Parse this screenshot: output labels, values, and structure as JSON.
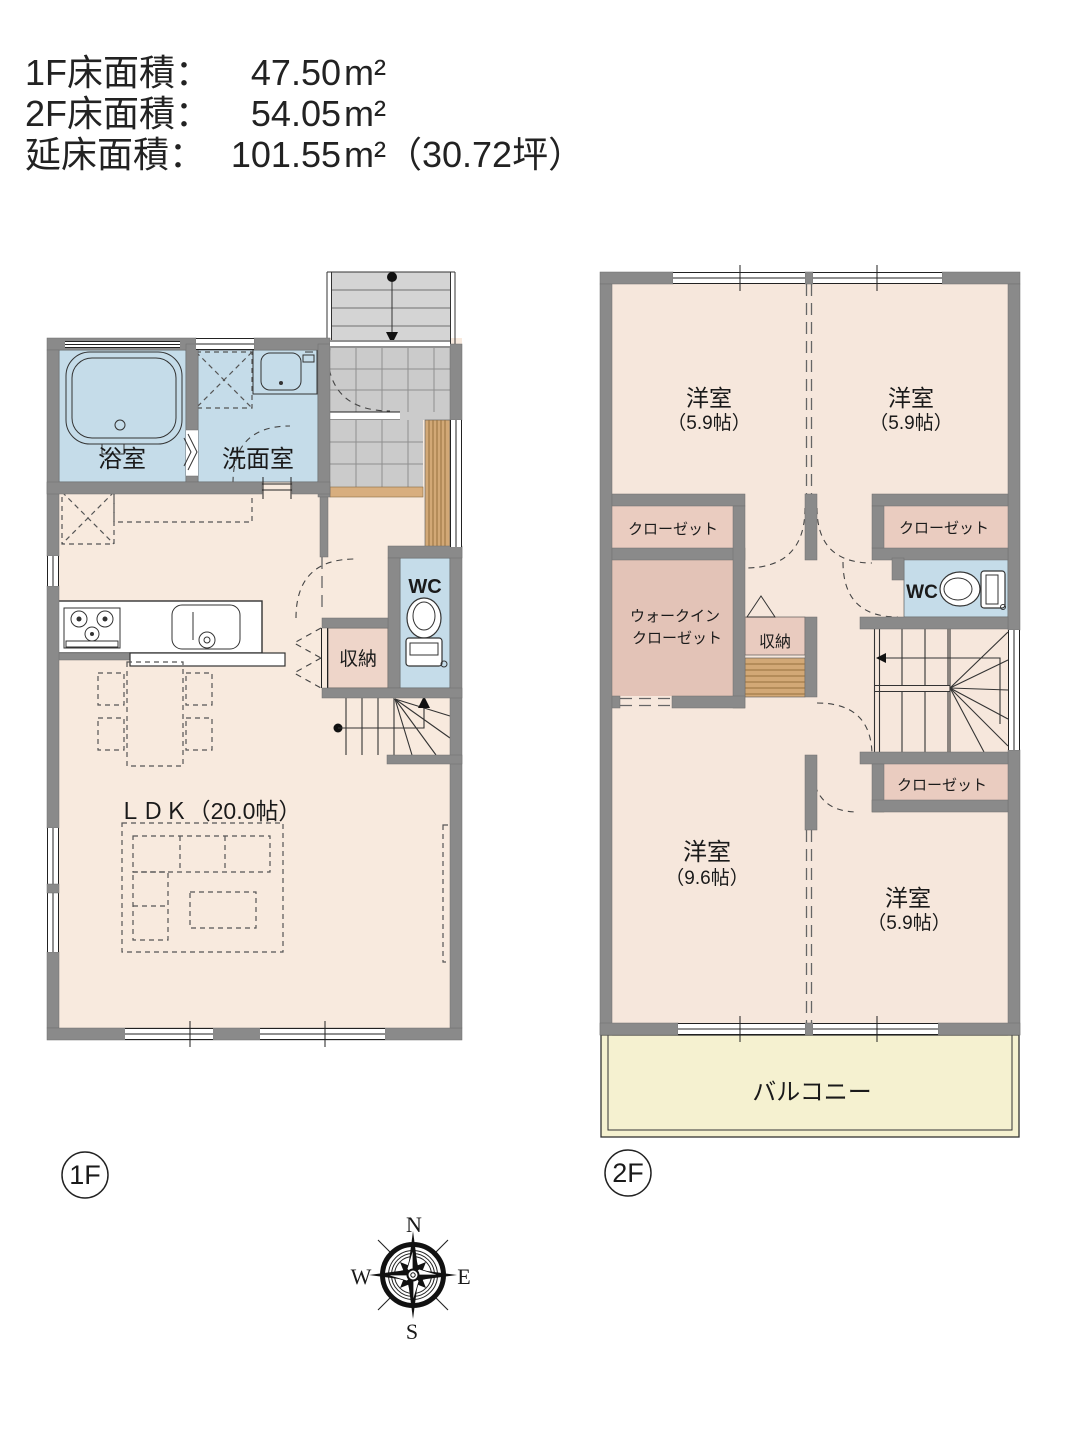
{
  "header": {
    "rows": [
      {
        "label": "1F床面積：",
        "value": "47.50",
        "unit": "m²"
      },
      {
        "label": "2F床面積：",
        "value": "54.05",
        "unit": "m²"
      },
      {
        "label": "延床面積：",
        "value": "101.55",
        "unit": "m²（30.72坪）"
      }
    ]
  },
  "floor1": {
    "badge": "1F",
    "labels": {
      "bath": "浴室",
      "wash": "洗面室",
      "wc": "WC",
      "storage": "収納",
      "ldk": "ＬＤＫ（20.0帖）"
    }
  },
  "floor2": {
    "badge": "2F",
    "labels": {
      "room_nw": "洋室",
      "room_nw_size": "（5.9帖）",
      "room_ne": "洋室",
      "room_ne_size": "（5.9帖）",
      "closet_nw": "クローゼット",
      "closet_ne": "クローゼット",
      "wic_line1": "ウォークイン",
      "wic_line2": "クローゼット",
      "storage": "収納",
      "wc": "WC",
      "closet_se": "クローゼット",
      "room_sw": "洋室",
      "room_sw_size": "（9.6帖）",
      "room_se": "洋室",
      "room_se_size": "（5.9帖）",
      "balcony": "バルコニー"
    }
  },
  "compass": {
    "north": "N",
    "south": "S",
    "east": "E",
    "west": "W"
  },
  "colors": {
    "wall": "#8a8a8a",
    "floor_1f": "#f8eade",
    "floor_2f": "#f6e7dc",
    "water_blue": "#c5dce9",
    "closet_pink": "#eaccc0",
    "walkin_pink": "#e3c3b7",
    "storage_pink_1f": "#eed5c9",
    "storage_pink_2f": "#e9cbbf",
    "balcony_yellow": "#f5f1d0",
    "tile_gray": "#cbcbcb",
    "porch_gray": "#d4d4d4",
    "wood_slat": "#d2a876",
    "step_tan": "#d8ae7e"
  }
}
